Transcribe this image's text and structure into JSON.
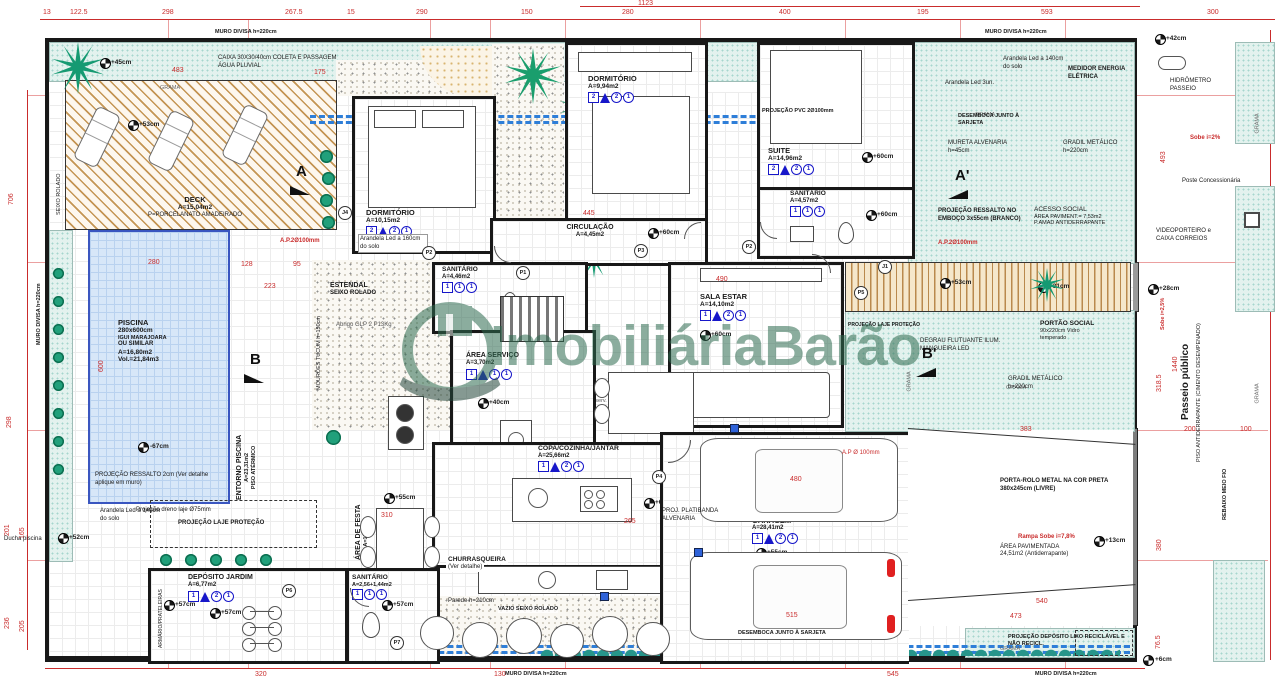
{
  "watermark": {
    "text": "ImobiliáriaBarão"
  },
  "rooms": [
    {
      "name": "DECK",
      "l1": "A=15,04m2",
      "l2": "P=PORCELANATO AMADEIRADO"
    },
    {
      "name": "PISCINA",
      "l1": "280x600cm",
      "l2": "IGUI MARAJOARA",
      "l3": "OU  SIMILAR",
      "l4": "A=16,80m2",
      "l5": "Vol.=21,84m3"
    },
    {
      "name": "DORMITÓRIO",
      "area": "A=10,15m2",
      "tags": [
        "2",
        "2",
        "1"
      ]
    },
    {
      "name": "DORMITÓRIO",
      "area": "A=9,94m2",
      "tags": [
        "2",
        "2",
        "1"
      ]
    },
    {
      "name": "SUITE",
      "area": "A=14,96m2",
      "tags": [
        "2",
        "2",
        "1"
      ]
    },
    {
      "name": "SANITÁRIO",
      "area": "A=4,57m2",
      "tags": [
        "1",
        "1",
        "1"
      ]
    },
    {
      "name": "CIRCULAÇÃO",
      "area": "A=4,45m2",
      "tags": [
        "1",
        "2",
        "1"
      ]
    },
    {
      "name": "SANITÁRIO",
      "area": "A=4,46m2",
      "tags": [
        "1",
        "1",
        "1"
      ]
    },
    {
      "name": "SALA ESTAR",
      "area": "A=14,10m2",
      "tags": [
        "1",
        "2",
        "1"
      ]
    },
    {
      "name": "ÁREA SERVIÇO",
      "area": "A=3,70m2",
      "tags": [
        "1",
        "1",
        "1"
      ]
    },
    {
      "name": "COPA/COZINHA/JANTAR",
      "area": "A=25,66m2",
      "tags": [
        "1",
        "2",
        "1"
      ]
    },
    {
      "name": "CHURRASQUEIRA",
      "area": "(Ver detalhe)"
    },
    {
      "name": "ÁREA DE FESTA",
      "area": "A=17,63m2",
      "tags": [
        "1"
      ]
    },
    {
      "name": "GARAGEM",
      "area": "A=28,41m2",
      "tags": [
        "1",
        "2",
        "1"
      ]
    },
    {
      "name": "DEPÓSITO JARDIM",
      "area": "A=6,77m2",
      "tags": [
        "1",
        "2",
        "1"
      ]
    },
    {
      "name": "SANITÁRIO",
      "area": "A=2,56+1,44m2",
      "tags": [
        "1",
        "1",
        "1"
      ]
    },
    {
      "name": "ENTORNO PISCINA",
      "l1": "A=23,31m2",
      "l2": "PISO ATÉRMICO"
    },
    {
      "name": "ACESSO SOCIAL",
      "l1": "ÁREA PAVIMENT.= 7,53m2",
      "l2": "P.AMAD ANTIDERRAPANTE"
    },
    {
      "name": "ÁREA PAVIMENTADA",
      "l1": "24,51m2 (Antiderrapante)"
    },
    {
      "name": "ESTENDAL",
      "l1": "SEIXO  ROLADO"
    }
  ],
  "labels": {
    "muro_divisa": "MURO  DIVISA  h=220cm",
    "caixa_coleta": "CAIXA 30X30/40cm COLETA E PASSAGEM ÁGUA PLUVIAL",
    "grama": "GRAMA",
    "arandela_160": "Arandela Led a 160cm do solo",
    "arandela_140": "Arandela Led a 140cm do solo",
    "arandela_3un": "Arandela Led 3un.",
    "medidor": "MEDIDOR ENERGIA ELÉTRICA",
    "hidrometro": "HIDRÔMETRO PASSEIO",
    "sobe_2": "Sobe i=2%",
    "sobe_25": "Sobe i=2,5%",
    "poste": "Poste Concessionária",
    "videoporteiro": "VIDEOPORTEIRO e CAIXA CORREIOS",
    "desemboca": "DESEMBOCA JUNTO À SARJETA",
    "mureta": "MURETA ALVENARIA h=45cm",
    "gradil": "GRADIL METÁLICO h=220cm",
    "proj_pvc": "PROJEÇÃO PVC 2Ø100mm",
    "proj_ressalto_emboco": "PROJEÇÃO RESSALTO NO EMBOÇO 3x55cm (BRANCO)",
    "ap_2_100": "A.P.2Ø100mm",
    "portao_social": "PORTÃO SOCIAL",
    "portao_social_sub": "90x220cm Vidro temperado",
    "degrau": "DEGRAU FLUTUANTE ILUM. MANGUEIRA LED",
    "passeio_publico": "Passeio público",
    "passeio_sub": "PISO ANTIDERRAPANTE (CIMENTO DESEMPENADO)",
    "porta_rolo": "PORTA-ROLO METAL NA COR PRETA 380x245cm (LIVRE)",
    "rampa_sobe": "Rampa Sobe i=7,8%",
    "proj_lixo": "PROJEÇÃO DEPÓSITO LIXO RECICLÁVEL E NÃO RECICL.",
    "ducha": "Ducha piscina",
    "dreno": "Projeção dreno laje Ø75mm",
    "proj_laje_protecao": "PROJEÇÃO  LAJE  PROTEÇÃO",
    "proj_ressalto_2cm": "PROJEÇÃO RESSALTO 2cm (Ver detalhe aplique em muro)",
    "abrigo_glp": "Abrigo GLP 2 P13Kg",
    "parede_210": "Parede h=210cm",
    "armario": "ARMÁRIO/PRATELEIRAS",
    "vazio_seixo": "VAZIO SEIXO ROLADO",
    "proj_platibanda_alv": "PROJ. PLATIBANDA ALVENARIA",
    "proj_laje_garagem": "PROJEÇÃO LAJE PROTEÇÃO À GARAGEM",
    "termino_rampa": "TÉRMINO RAMPA",
    "termino_inicio": "TÉRMINO/INÍCIO RAMPA",
    "ap_100": "A.P Ø 100mm",
    "seixo_rolado": "SEIXO  ROLADO",
    "proj_reserv": "Projeção Reserv. D'água 1.000L",
    "proj_platibanda_v": "PROJEÇÃO PLATIBANDA",
    "mouroes": "MOURÕES TUCUM h=150cm",
    "rebaixo": "REBAIXO MEIO FIO",
    "proj_laje_portao": "PROJEÇÃO LAJE PROTEÇÃO PORTÃO"
  },
  "sections": {
    "a": "A",
    "a2": "A'",
    "b": "B",
    "b2": "B'"
  },
  "doors": [
    "P1",
    "P2",
    "P3",
    "P4",
    "P5",
    "P6",
    "P7",
    "J1",
    "J4"
  ],
  "elevations": [
    "+45cm",
    "+53cm",
    "+60cm",
    "+60cm",
    "+60cm",
    "+60cm",
    "+60cm",
    "+55cm",
    "+55cm",
    "+57cm",
    "+57cm",
    "+53cm",
    "+52cm",
    "-67cm",
    "+42cm",
    "+28cm",
    "+31cm",
    "+13cm",
    "+40cm",
    "+6cm"
  ],
  "dims": {
    "overall_top": "1123",
    "top": [
      "13",
      "122.5",
      "298",
      "267.5",
      "15",
      "290",
      "150",
      "280",
      "400",
      "195",
      "593",
      "300"
    ],
    "left": [
      "706",
      "298",
      "201",
      "165",
      "236",
      "205"
    ],
    "right": [
      "493",
      "1440",
      "318.5",
      "103",
      "380",
      "76.5"
    ],
    "bottom": [
      "320",
      "130",
      "545"
    ],
    "inner": [
      "483",
      "175",
      "280",
      "128",
      "95",
      "223",
      "600",
      "445",
      "490",
      "310",
      "265",
      "480",
      "515",
      "540",
      "473",
      "383",
      "200",
      "100"
    ]
  },
  "colors": {
    "dim_red": "#c92c2c",
    "wall": "#181818",
    "pipe_blue": "#2e7ed8",
    "watermark_green": "#2e6b50",
    "grass": "#e3f2ee",
    "pool_border": "#3a56c0",
    "tag_blue": "#1717c9"
  }
}
